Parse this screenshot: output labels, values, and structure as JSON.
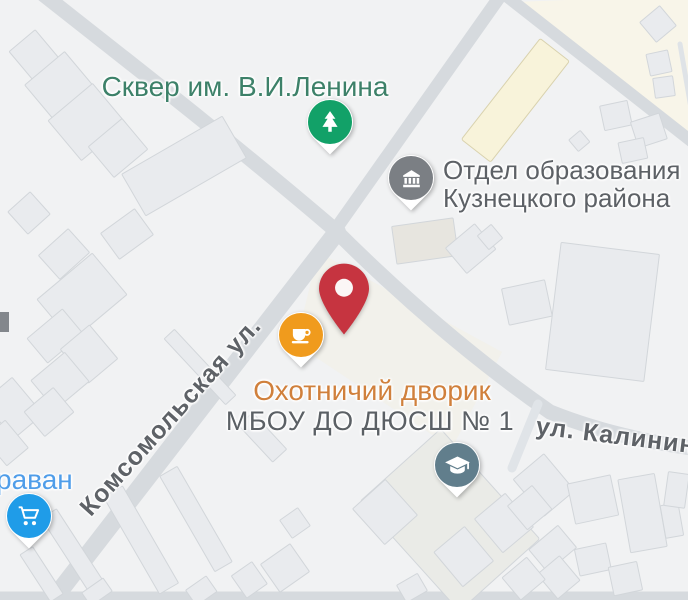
{
  "map_labels": {
    "park": "Сквер им. В.И.Ленина",
    "education_department_line1": "Отдел образования",
    "education_department_line2": "Кузнецкого района",
    "cafe": "Охотничий дворик",
    "sports_school": "МБОУ ДО ДЮСШ № 1",
    "store": "раван",
    "street_komsomolskaya": "Комсомольская ул.",
    "street_kalinina": "ул. Калинина"
  },
  "markers": {
    "park": {
      "icon": "tree-icon",
      "color": "#12A168"
    },
    "education": {
      "icon": "museum-icon",
      "color": "#7B7F84"
    },
    "cafe": {
      "icon": "coffee-cup-icon",
      "color": "#F09B1D"
    },
    "school": {
      "icon": "graduation-cap-icon",
      "color": "#617E8C"
    },
    "store": {
      "icon": "shopping-cart-icon",
      "color": "#1F9CE8"
    },
    "destination": {
      "icon": "location-pin-icon",
      "color": "#C63440"
    }
  },
  "label_colors": {
    "park_label": "#3D8169",
    "poi_gray_label": "#5D6166",
    "cafe_label": "#D0803C",
    "store_label": "#4F9DE9",
    "street_label": "#5E6267"
  },
  "map_style": {
    "background": "#F1F2F3",
    "road": "#D6DADE",
    "building_fill": "#E9EBEE",
    "building_stroke": "#D2D6DA",
    "highlight_building_fill": "#F8F3DA"
  }
}
